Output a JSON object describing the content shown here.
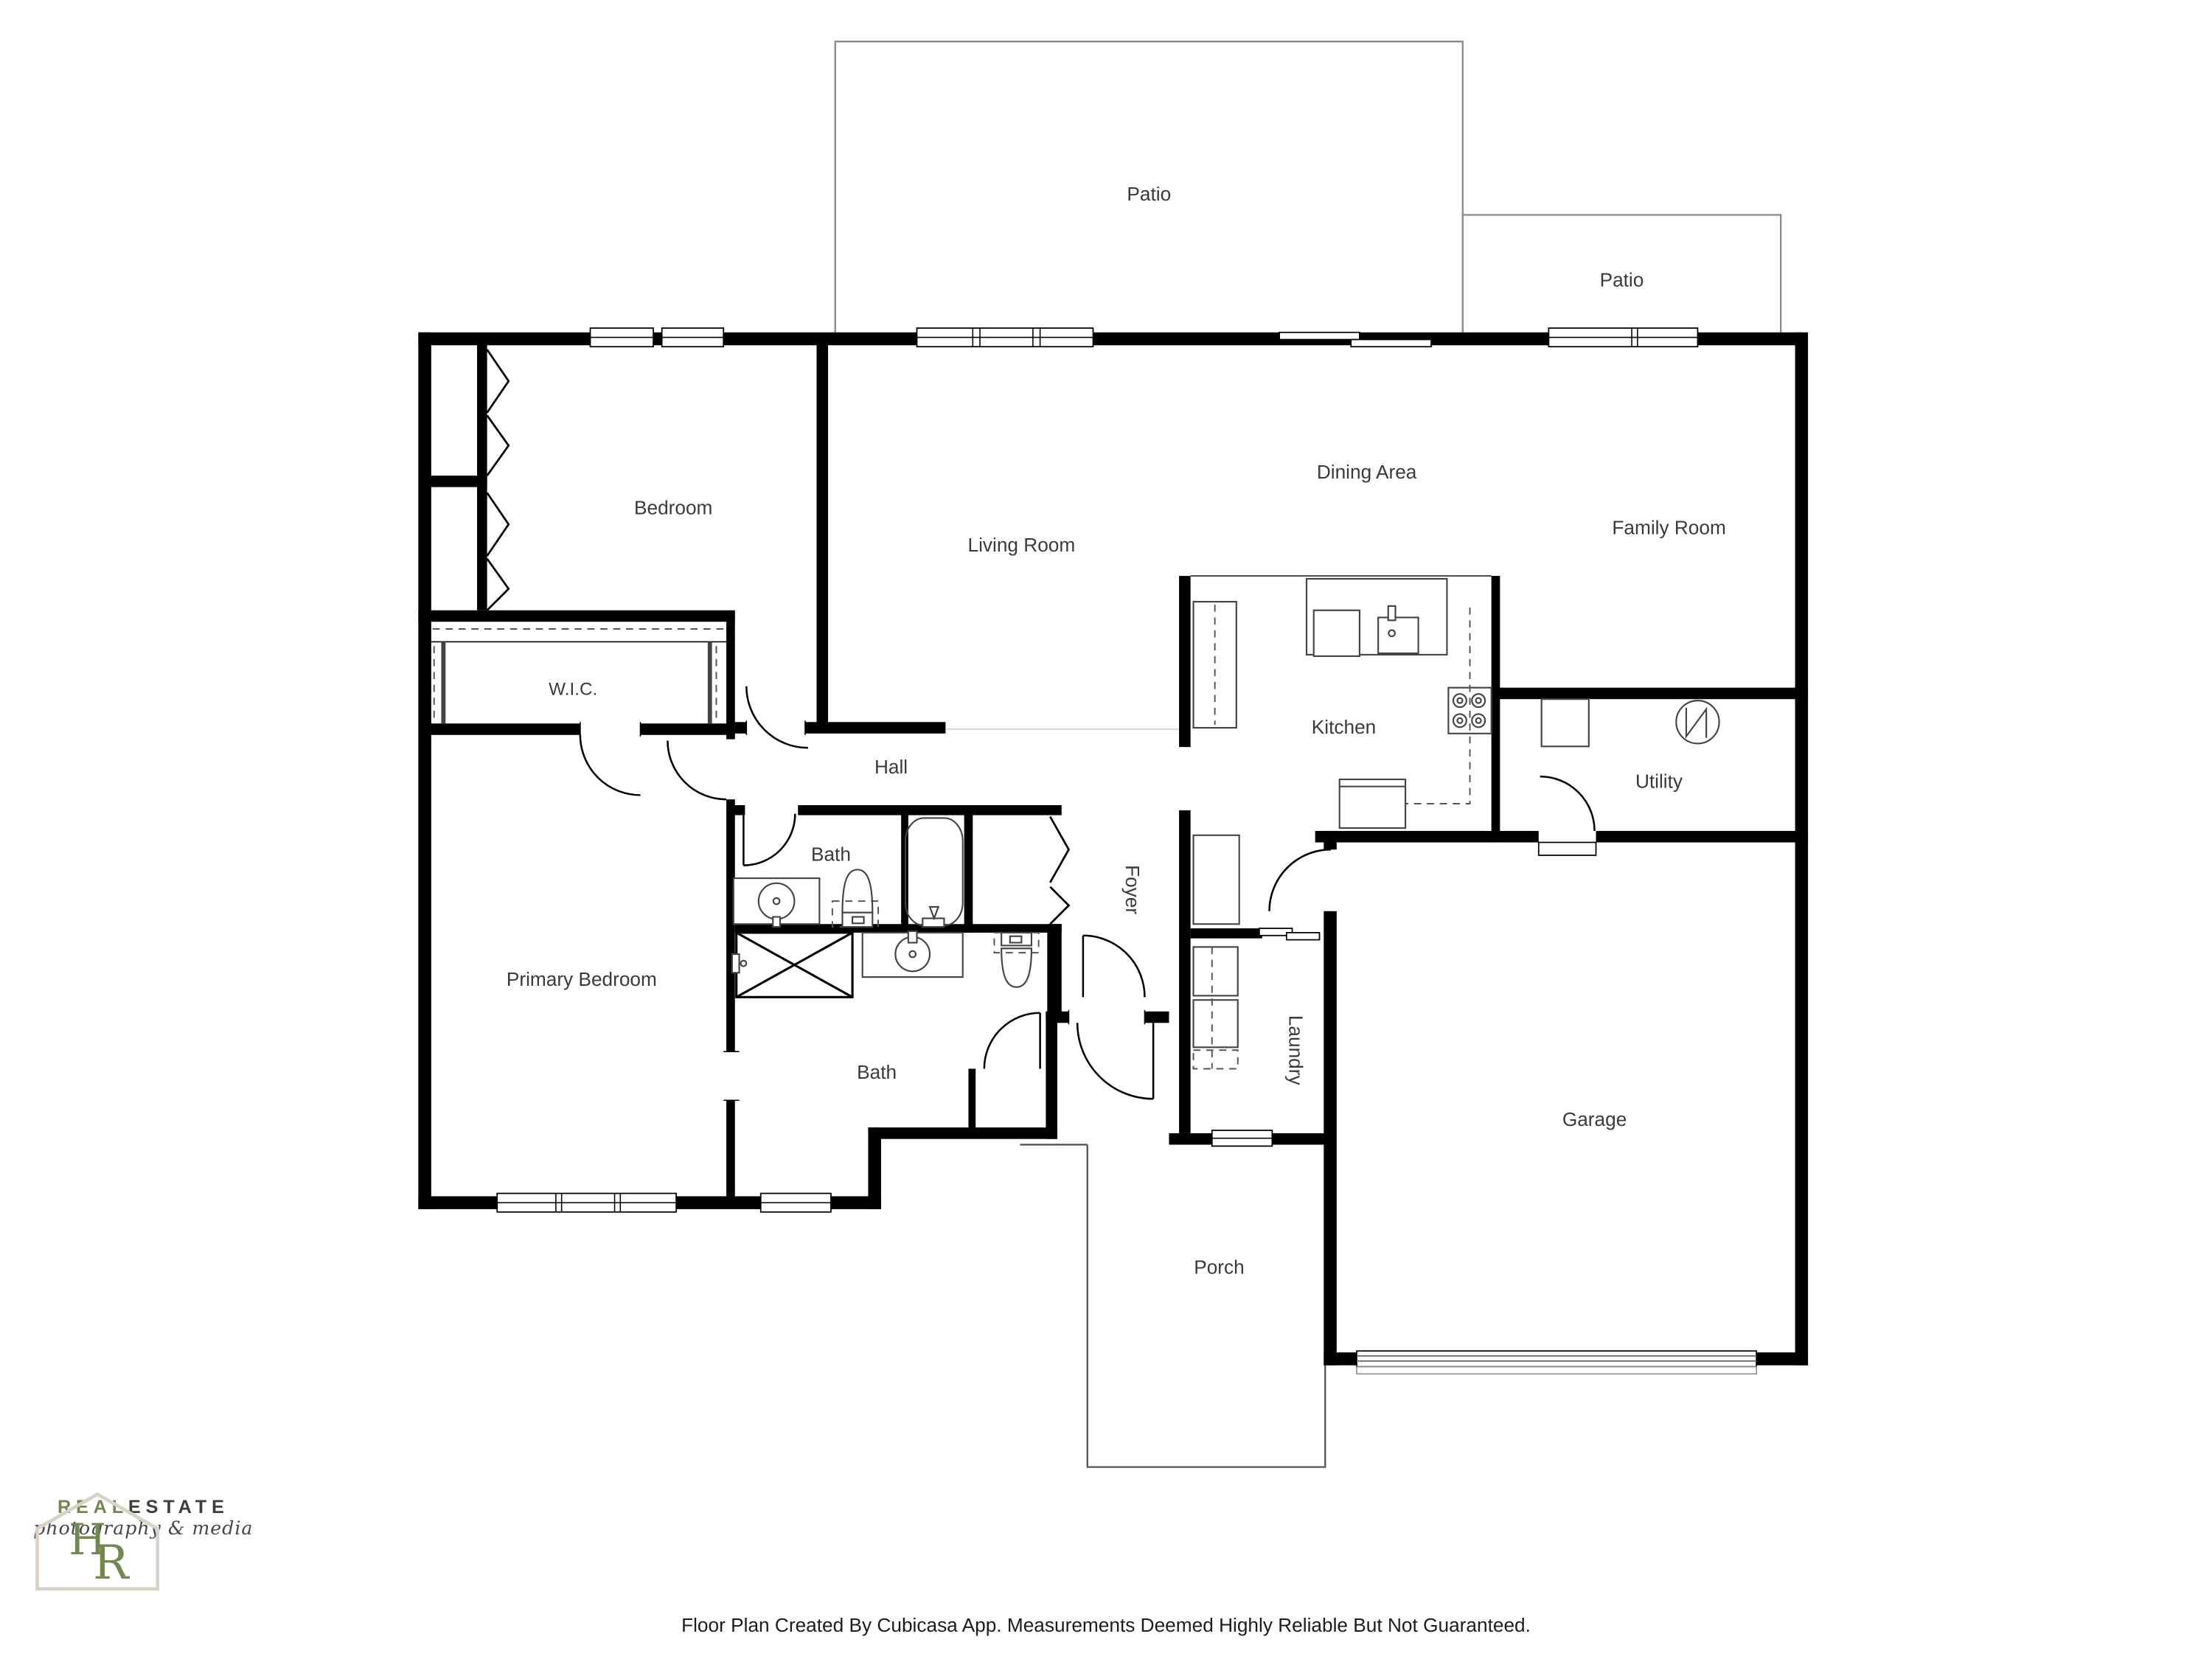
{
  "rooms": {
    "patio_top": "Patio",
    "patio_right": "Patio",
    "bedroom": "Bedroom",
    "living": "Living Room",
    "dining": "Dining Area",
    "family": "Family Room",
    "wic": "W.I.C.",
    "hall": "Hall",
    "kitchen": "Kitchen",
    "utility": "Utility",
    "bath_hall": "Bath",
    "bath_lower": "Bath",
    "primary": "Primary Bedroom",
    "foyer": "Foyer",
    "laundry": "Laundry",
    "garage": "Garage",
    "porch": "Porch"
  },
  "footer": {
    "disclaimer": "Floor Plan Created By Cubicasa App. Measurements Deemed Highly Reliable But Not Guaranteed."
  },
  "logo": {
    "monogram_h": "H",
    "monogram_r": "R",
    "brand_green": "REAL",
    "brand_dark": "ESTATE",
    "tagline": "photography & media"
  },
  "colors": {
    "wall": "#000000",
    "label": "#3a3a3a",
    "patio_outline": "#8a8a8a",
    "porch_outline": "#555555",
    "logo_green": "#71894f",
    "logo_dark": "#3c3f38"
  }
}
